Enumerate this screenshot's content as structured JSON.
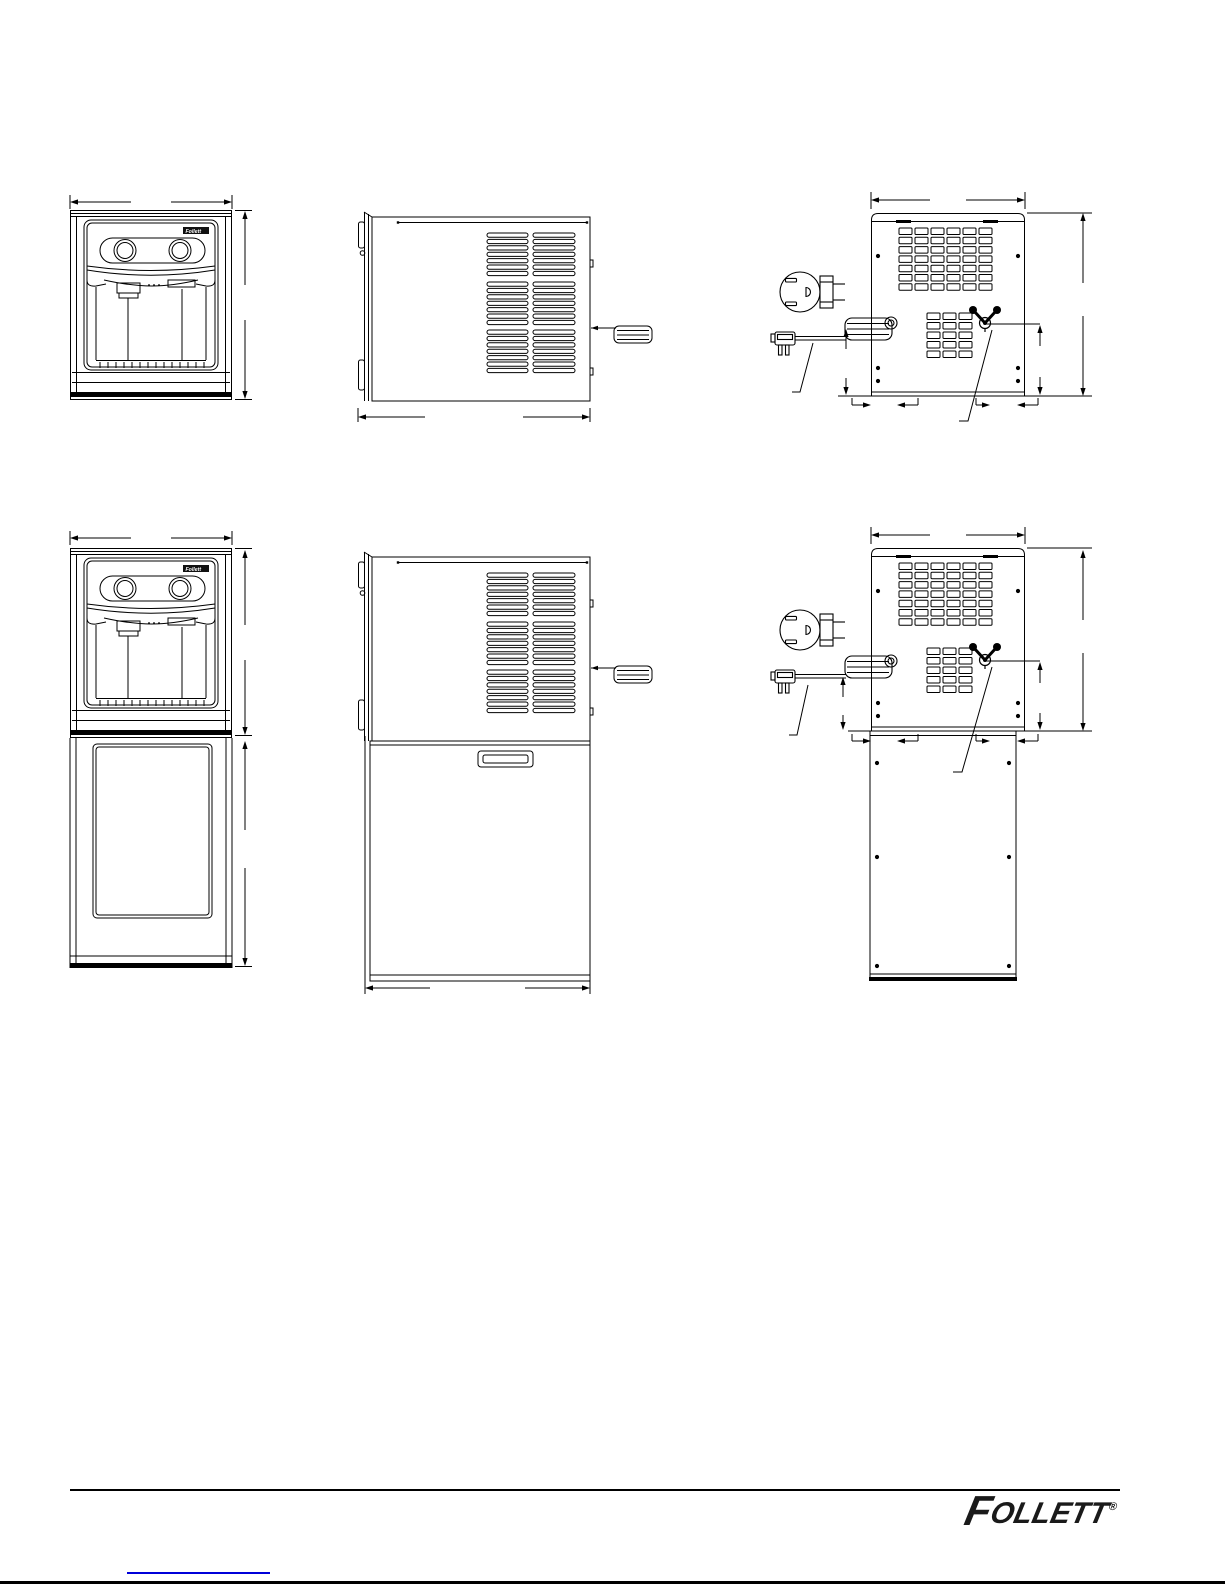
{
  "page": {
    "background": "#ffffff",
    "line_color": "#000000"
  },
  "branding": {
    "unit_badge_text": "Follett",
    "logo_initial": "F",
    "logo_rest": "OLLETT",
    "registered_mark": "®",
    "logo_color": "#1a1a1a"
  },
  "footer": {
    "divider_color": "#000000",
    "link_color": "#0000d9",
    "page_edge_color": "#000000"
  },
  "icons": {
    "outlet": "nema-outlet-icon",
    "plug": "power-plug-icon",
    "cord": "coiled-power-cord-icon",
    "valve": "water-inlet-valve-icon"
  }
}
